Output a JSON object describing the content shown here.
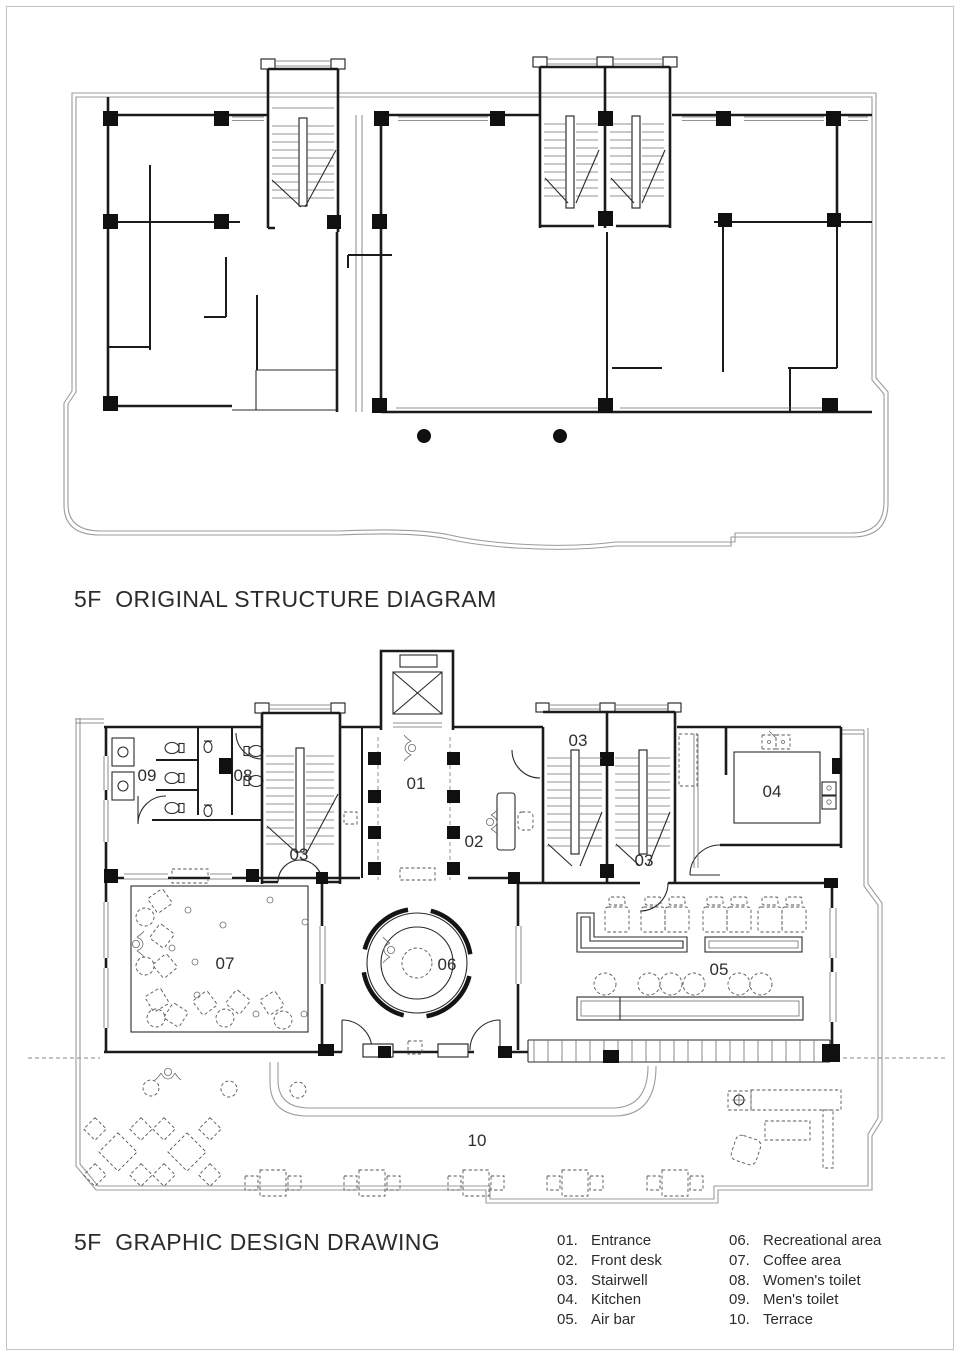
{
  "page": {
    "background": "#ffffff",
    "border_color": "#c2c2c2",
    "wall_color": "#1b1b1b",
    "boundary_color": "#9c9c9c",
    "text_color": "#2b2b2b"
  },
  "top_plan": {
    "title": "5F  ORIGINAL STRUCTURE DIAGRAM"
  },
  "bottom_plan": {
    "title": "5F  GRAPHIC DESIGN DRAWING",
    "labels": {
      "entrance": "01",
      "front_desk": "02",
      "stairwell": "03",
      "kitchen": "04",
      "air_bar": "05",
      "recreation": "06",
      "coffee": "07",
      "womens_toilet": "08",
      "mens_toilet": "09",
      "terrace": "10"
    }
  },
  "legend": {
    "col1": [
      {
        "num": "01.",
        "label": "Entrance"
      },
      {
        "num": "02.",
        "label": "Front desk"
      },
      {
        "num": "03.",
        "label": "Stairwell"
      },
      {
        "num": "04.",
        "label": "Kitchen"
      },
      {
        "num": "05.",
        "label": "Air bar"
      }
    ],
    "col2": [
      {
        "num": "06.",
        "label": "Recreational area"
      },
      {
        "num": "07.",
        "label": "Coffee area"
      },
      {
        "num": "08.",
        "label": "Women's toilet"
      },
      {
        "num": "09.",
        "label": "Men's toilet"
      },
      {
        "num": "10.",
        "label": "Terrace"
      }
    ]
  }
}
